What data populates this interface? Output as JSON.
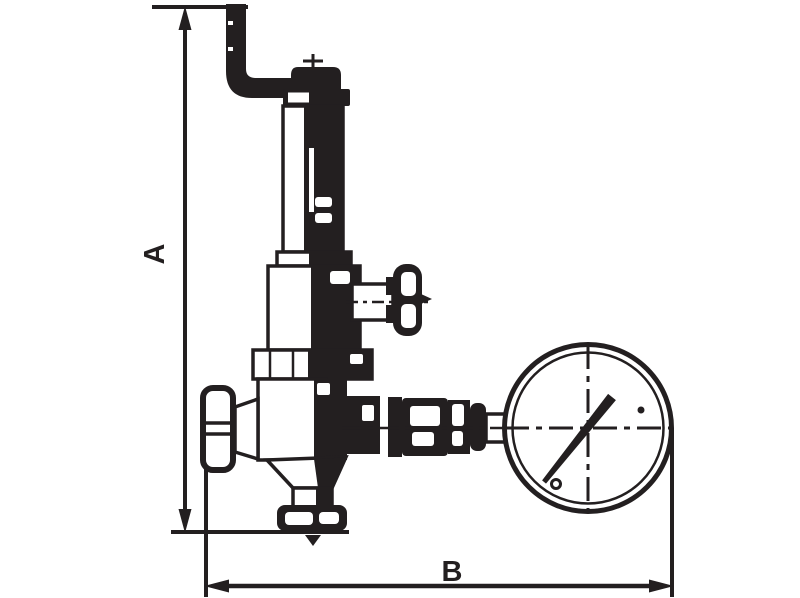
{
  "figure": {
    "type": "technical-dimension-drawing",
    "subject": "Pressure reducing valve with inlet elbow pipe, spring housing, side T-handle valve, handwheel, bottom outlet union and pressure gauge",
    "ink_color": "#231f20",
    "background_color": "#ffffff"
  },
  "dimensions": {
    "vertical_label": "A",
    "horizontal_label": "B"
  }
}
